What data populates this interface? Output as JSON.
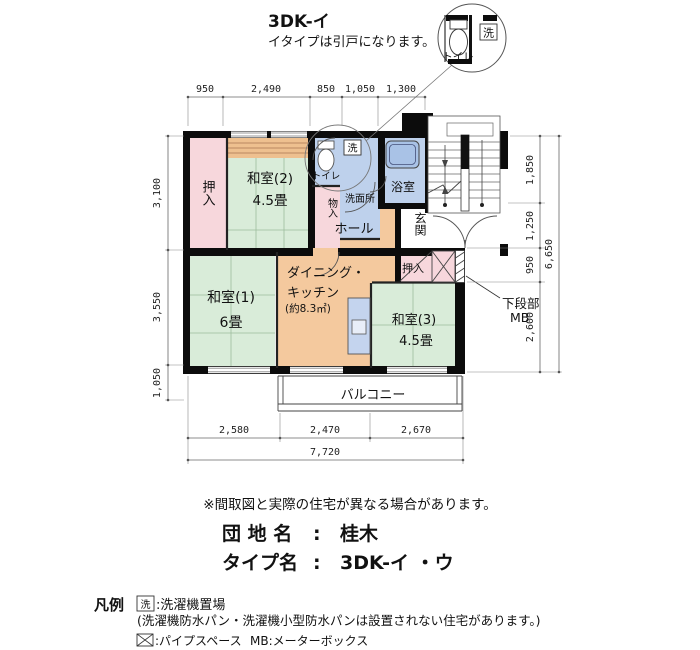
{
  "title": {
    "main": "3DK-イ",
    "subtitle": "イタイプは引戸になります。"
  },
  "detail_callout": {
    "toilet_label": "トイレ",
    "washer_label": "洗"
  },
  "rooms": {
    "oshiire1": "押入",
    "washitsu2": "和室(2)",
    "washitsu2_size": "4.5畳",
    "toilet": "トイレ",
    "monoire": "物入",
    "washer_box": "洗",
    "senmenjo": "洗面所",
    "bath": "浴室",
    "hall": "ホール",
    "genkan": "玄関",
    "washitsu1": "和室(1)",
    "washitsu1_size": "6畳",
    "dk_line1": "ダイニング・",
    "dk_line2": "キッチン",
    "dk_size": "(約8.3㎡)",
    "oshiire3": "押入",
    "washitsu3": "和室(3)",
    "washitsu3_size": "4.5畳",
    "balcony": "バルコニー",
    "mb_note_line1": "下段部",
    "mb_note_line2": "MB"
  },
  "dimensions": {
    "top": [
      "950",
      "2,490",
      "850",
      "1,050",
      "1,300"
    ],
    "left": [
      "3,100",
      "3,550",
      "1,050"
    ],
    "right": [
      "1,850",
      "1,250",
      "950",
      "2,600"
    ],
    "right_total": "6,650",
    "bottom": [
      "2,580",
      "2,470",
      "2,670"
    ],
    "bottom_total": "7,720"
  },
  "footer": {
    "note": "※間取図と実際の住宅が異なる場合があります。",
    "danchi_label": "団 地 名",
    "danchi_sep": ":",
    "danchi_value": "桂木",
    "type_label": "タイプ名",
    "type_sep": ":",
    "type_value": "3DK-イ ・ウ"
  },
  "legend": {
    "heading": "凡例",
    "washer_symbol": "洗",
    "washer_text": ":洗濯機置場",
    "washer_note": "(洗濯機防水パン・洗濯機小型防水パンは設置されない住宅があります。)",
    "ps_text": ":パイプスペース",
    "mb_text": "MB:メーターボックス"
  },
  "palette": {
    "tatami_green": "#d9ecd9",
    "closet_pink": "#f7d7dc",
    "wet_area_blue": "#bed1ec",
    "wood_orange": "#f4c99e",
    "shelf_tan": "#eec08f",
    "wall_black": "#0c0c0c"
  }
}
